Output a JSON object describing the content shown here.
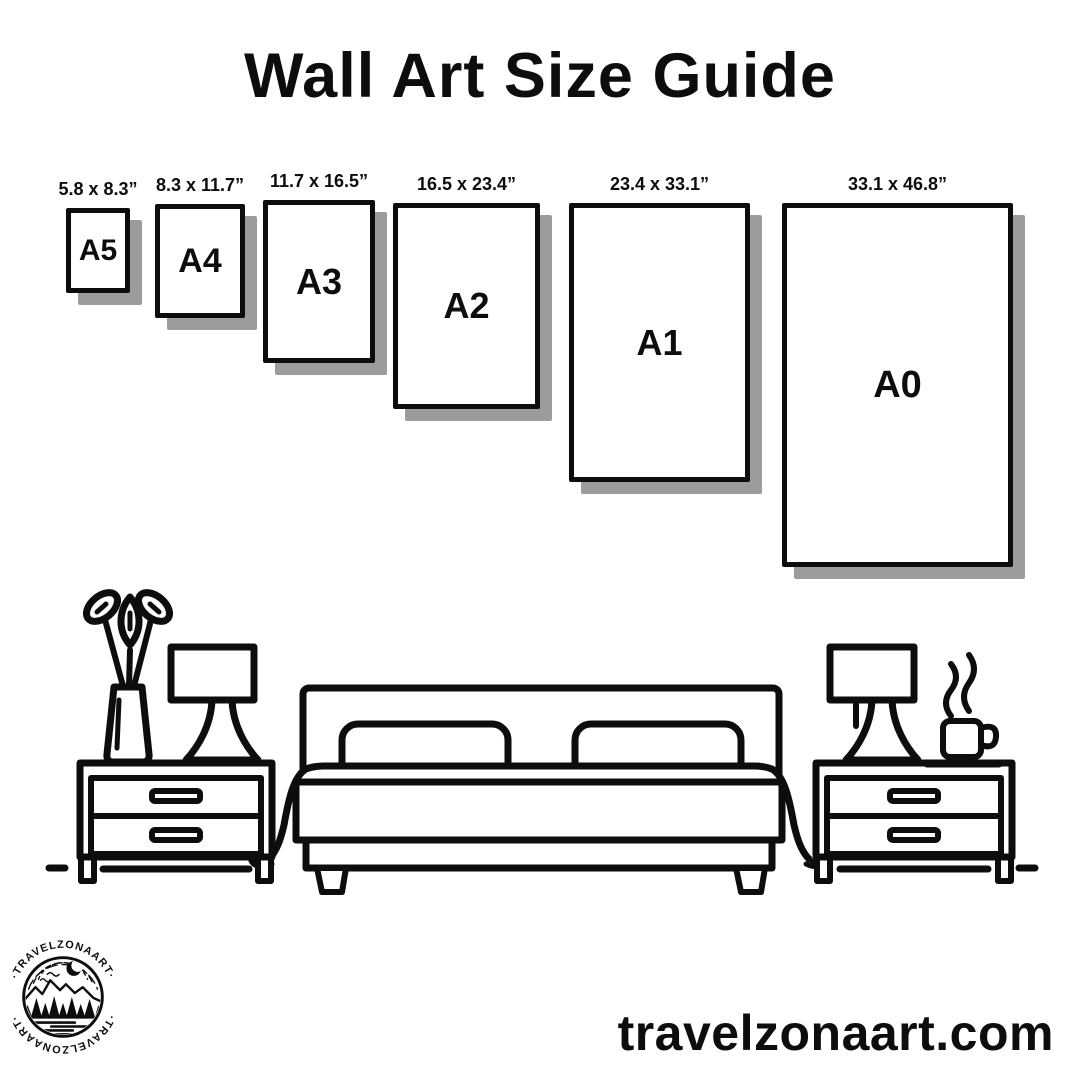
{
  "title": "Wall Art Size Guide",
  "sizes": [
    {
      "label": "A5",
      "dims": "5.8 x 8.3”"
    },
    {
      "label": "A4",
      "dims": "8.3 x 11.7”"
    },
    {
      "label": "A3",
      "dims": "11.7 x 16.5”"
    },
    {
      "label": "A2",
      "dims": "16.5 x 23.4”"
    },
    {
      "label": "A1",
      "dims": "23.4 x 33.1”"
    },
    {
      "label": "A0",
      "dims": "33.1 x 46.8”"
    }
  ],
  "illustration": {
    "icons": [
      "flower-vase-icon",
      "table-lamp-icon",
      "nightstand-icon",
      "double-bed-icon",
      "pillow-icon",
      "blanket-icon",
      "coffee-cup-icon",
      "steam-icon",
      "floor-line-icon"
    ]
  },
  "logo": {
    "arc_text_top": "·TRAVELZONAART·",
    "arc_text_bottom": "·TRAVELZONAART·",
    "icons": [
      "crescent-moon-icon",
      "birds-icon",
      "mountains-icon",
      "pine-trees-icon",
      "lake-icon"
    ]
  },
  "footer": {
    "website": "travelzonaart.com"
  },
  "colors": {
    "ink": "#0d0d0d",
    "shadow": "#9c9c9c",
    "background": "#ffffff"
  }
}
